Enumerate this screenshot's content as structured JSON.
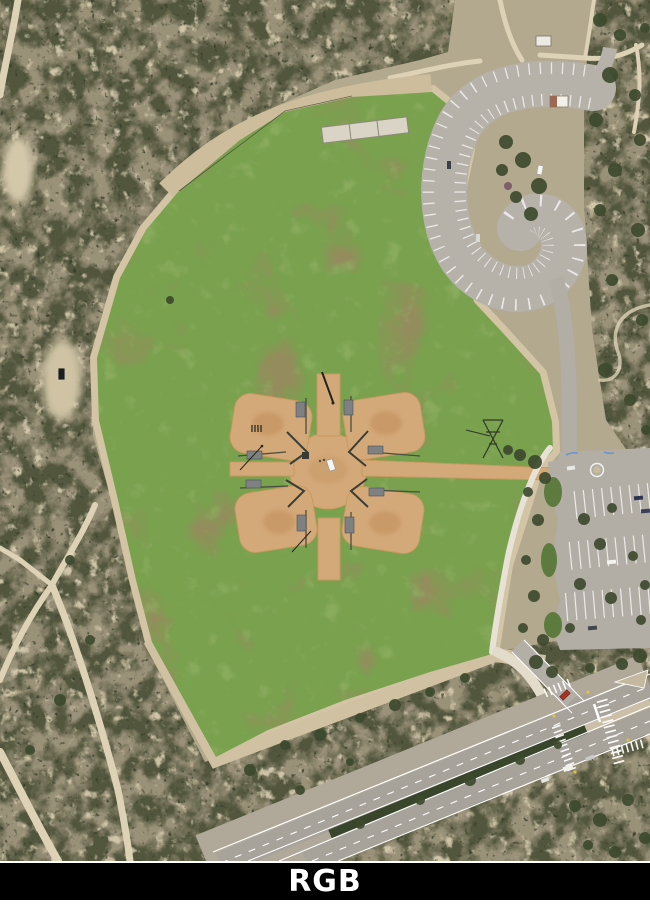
{
  "label": {
    "text": "RGB"
  },
  "colors": {
    "page_bg": "#ffffff",
    "label_bg": "#000000",
    "label_text": "#ffffff",
    "terrain_base": "#b3a98f",
    "scrub_dark": "#4e5339",
    "scrub_light": "#d8cdb0",
    "scrub_dots": "#333a27",
    "grass": "#79a14e",
    "grass_patch": "#99895f",
    "grass_dry": "#93b063",
    "dirt_trail": "#ddd2b6",
    "infield_dirt": "#d4a97a",
    "infield_shade": "#c3935f",
    "pavement": "#b4b0a8",
    "asphalt": "#a7a39b",
    "concrete_path": "#e7e2d5",
    "median_green": "#3a462c",
    "tree_green": "#3d4a2e",
    "stripe": "#ffffff"
  },
  "scene": {
    "kind": "aerial-orthophoto",
    "landmarks": [
      "chaparral hillside",
      "dirt trails",
      "grass park field",
      "4-field ball diamond complex",
      "central plaza",
      "curved parking loop",
      "parking lot",
      "mini roundabout",
      "access road",
      "divided road with crosswalk intersection"
    ]
  }
}
